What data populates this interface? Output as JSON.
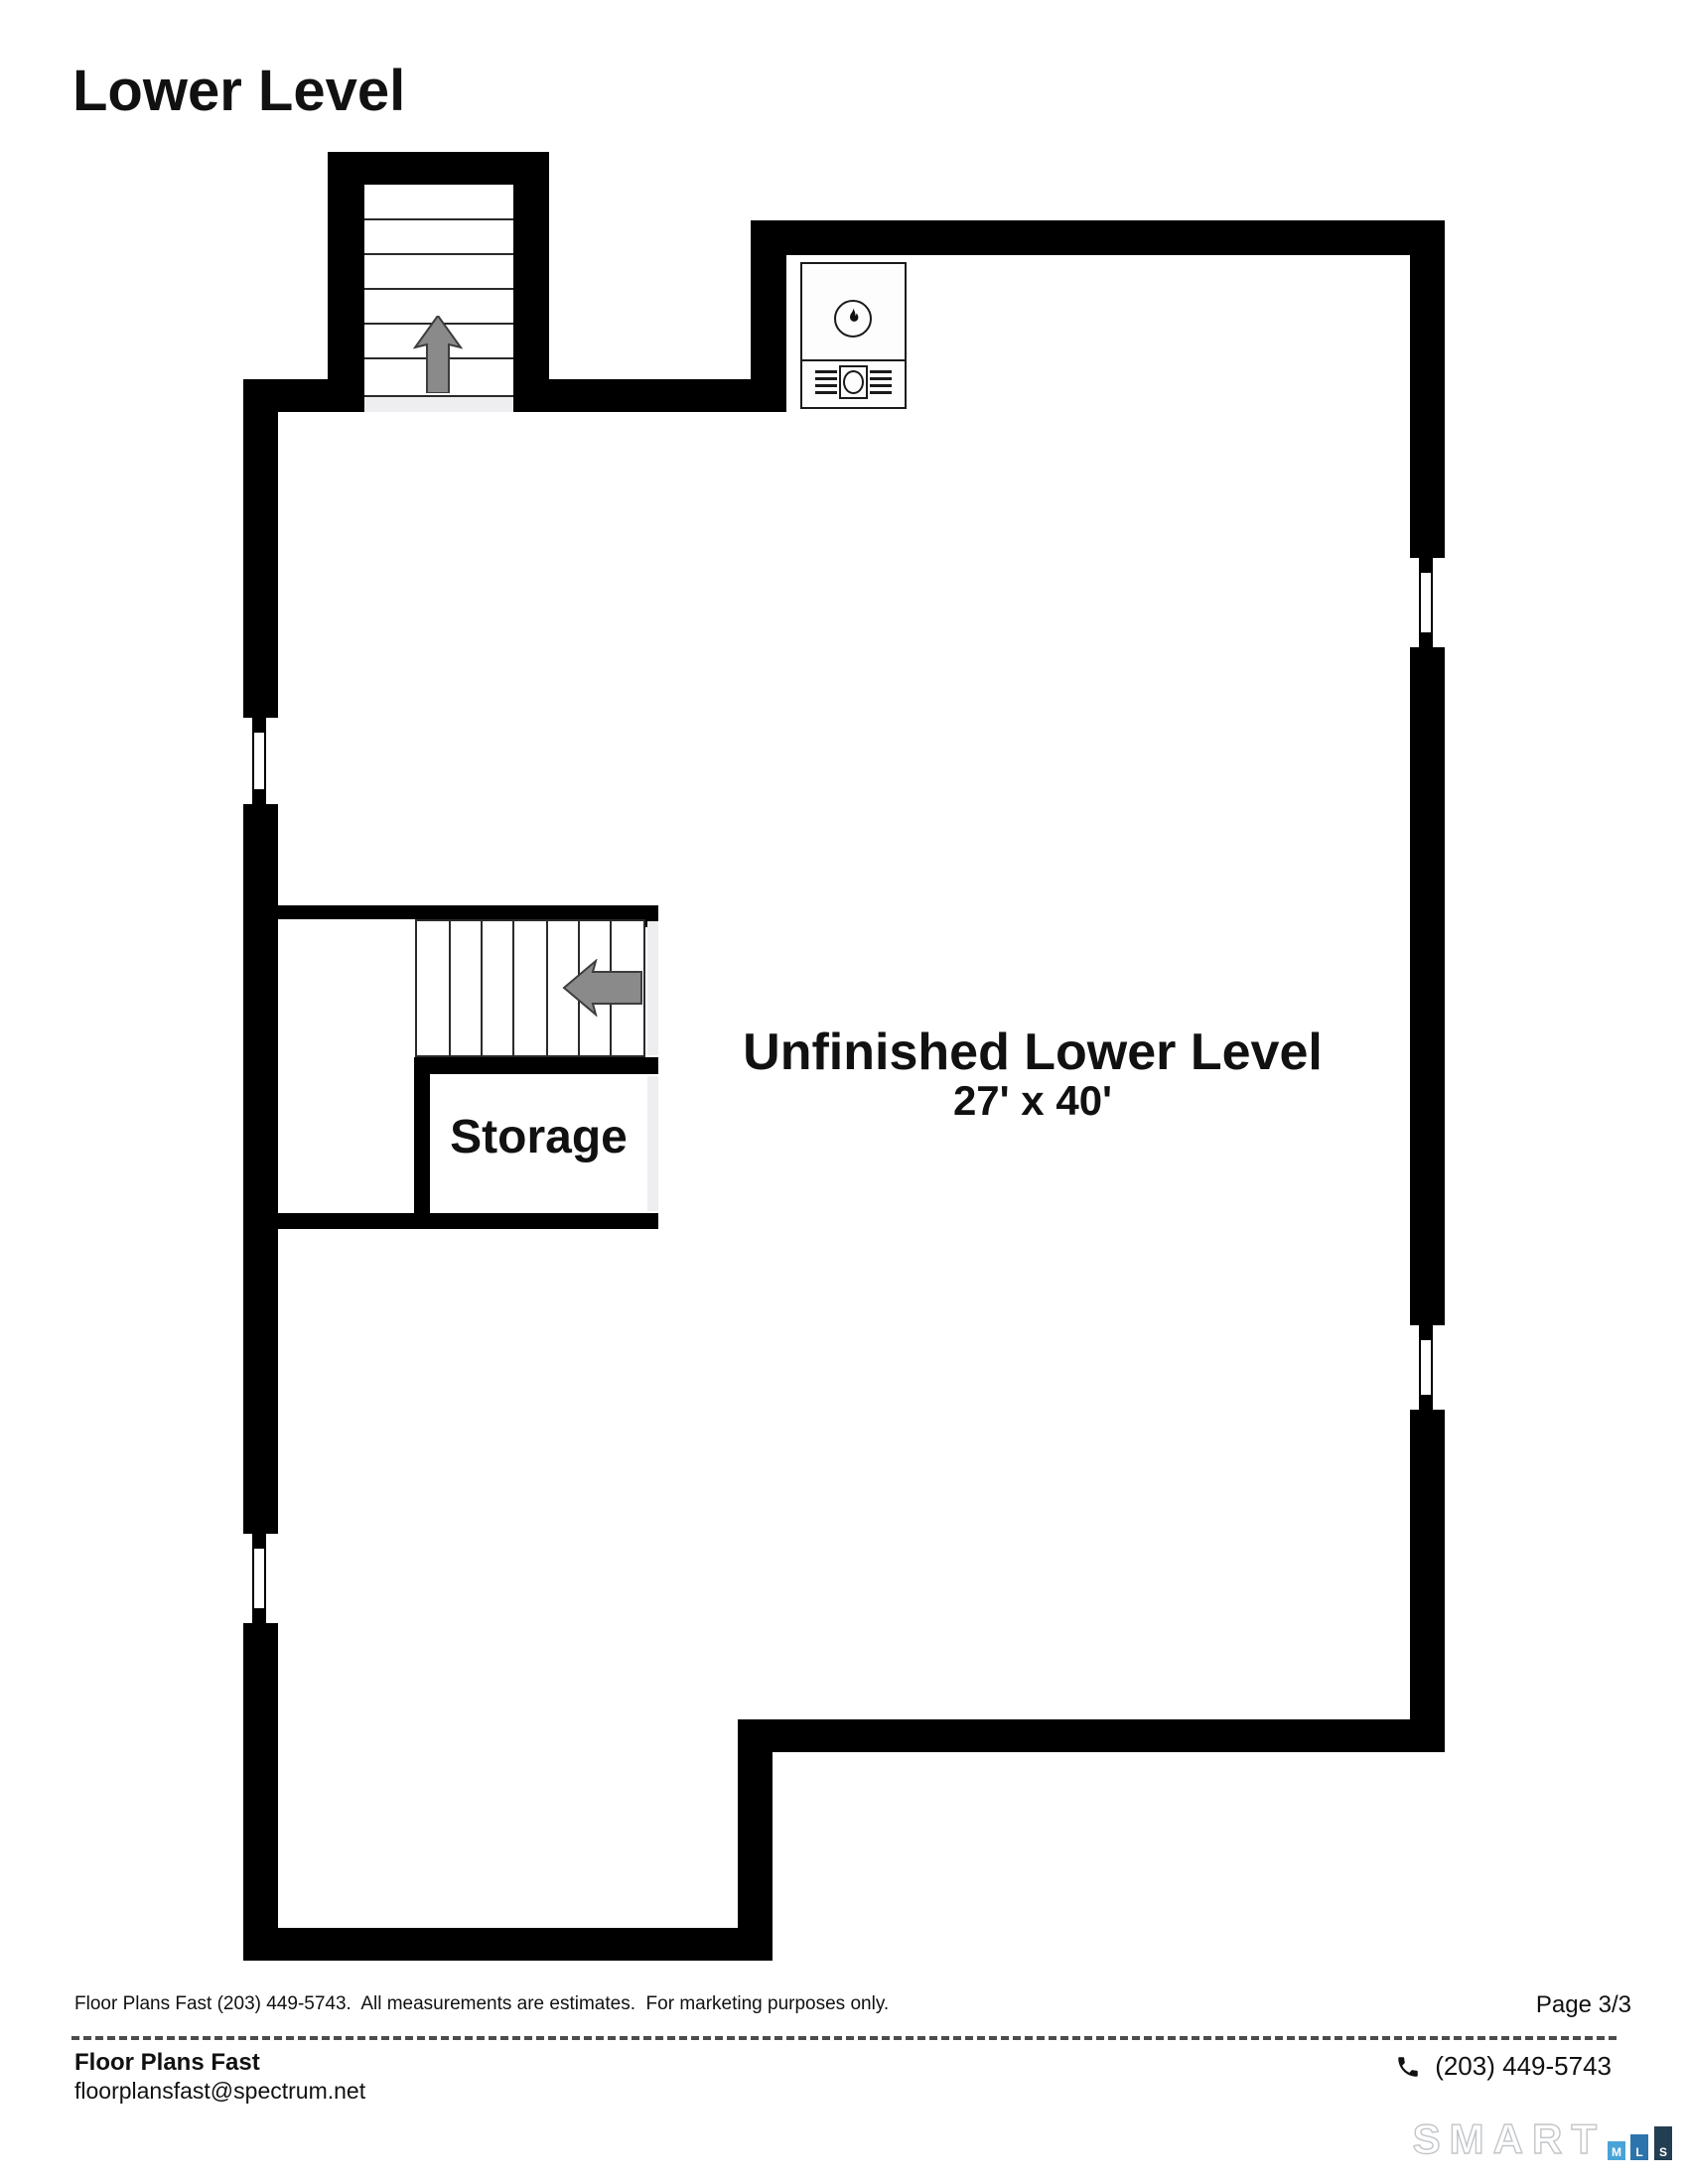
{
  "page": {
    "title": "Lower Level",
    "page_number": "Page 3/3"
  },
  "plan": {
    "main_room": {
      "name": "Unfinished Lower Level",
      "dimensions": "27' x 40'"
    },
    "storage_room": {
      "name": "Storage"
    }
  },
  "footer": {
    "disclaimer": "Floor Plans Fast (203) 449-5743.  All measurements are estimates.  For marketing purposes only.",
    "company_name": "Floor Plans Fast",
    "email": "floorplansfast@spectrum.net",
    "phone": "(203) 449-5743"
  },
  "branding": {
    "wordmark": "SMART",
    "mls_letters": [
      "M",
      "L",
      "S"
    ],
    "colors": {
      "mls_m": "#4aa3d8",
      "mls_l": "#2d74ac",
      "mls_s": "#223e52",
      "wall": "#000000",
      "opening_gray": "#eeeef1",
      "arrow_gray": "#8a8a8a"
    }
  },
  "icons": {
    "up_arrow": "stairs-up-arrow",
    "left_arrow": "stairs-down-arrow",
    "flame": "gas-appliance-flame",
    "phone": "telephone-handset"
  }
}
